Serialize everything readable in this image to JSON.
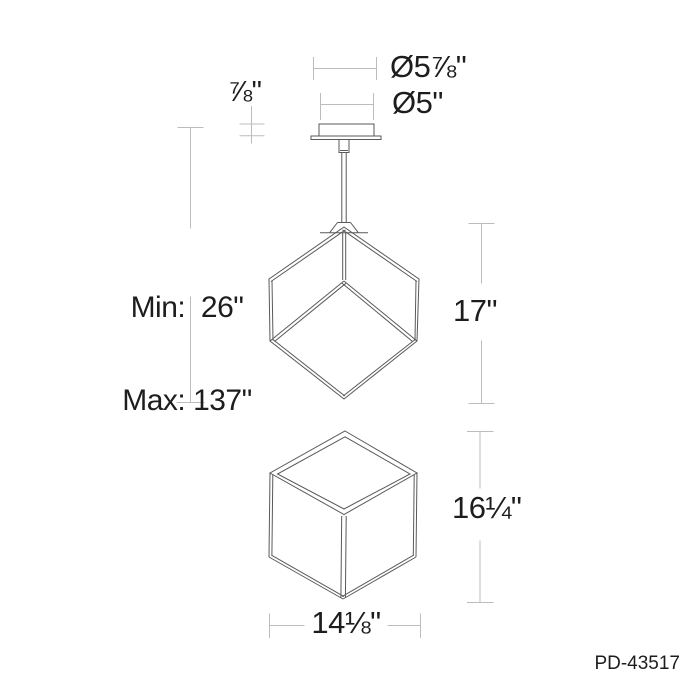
{
  "product": {
    "code": "PD-43517"
  },
  "labels": {
    "canopy_outer_diameter": "Ø5⅞\"",
    "canopy_diameter": "Ø5\"",
    "canopy_height": "⅞\"",
    "suspension": [
      "Min:  26\"",
      "Max: 137\""
    ],
    "fixture_height": "17\"",
    "cube_height": "16¼\"",
    "cube_width": "14⅛\""
  },
  "colors": {
    "background": "#ffffff",
    "object_line": "#595959",
    "dimension_line": "#bcbcbc",
    "text": "#1d1d1d"
  }
}
